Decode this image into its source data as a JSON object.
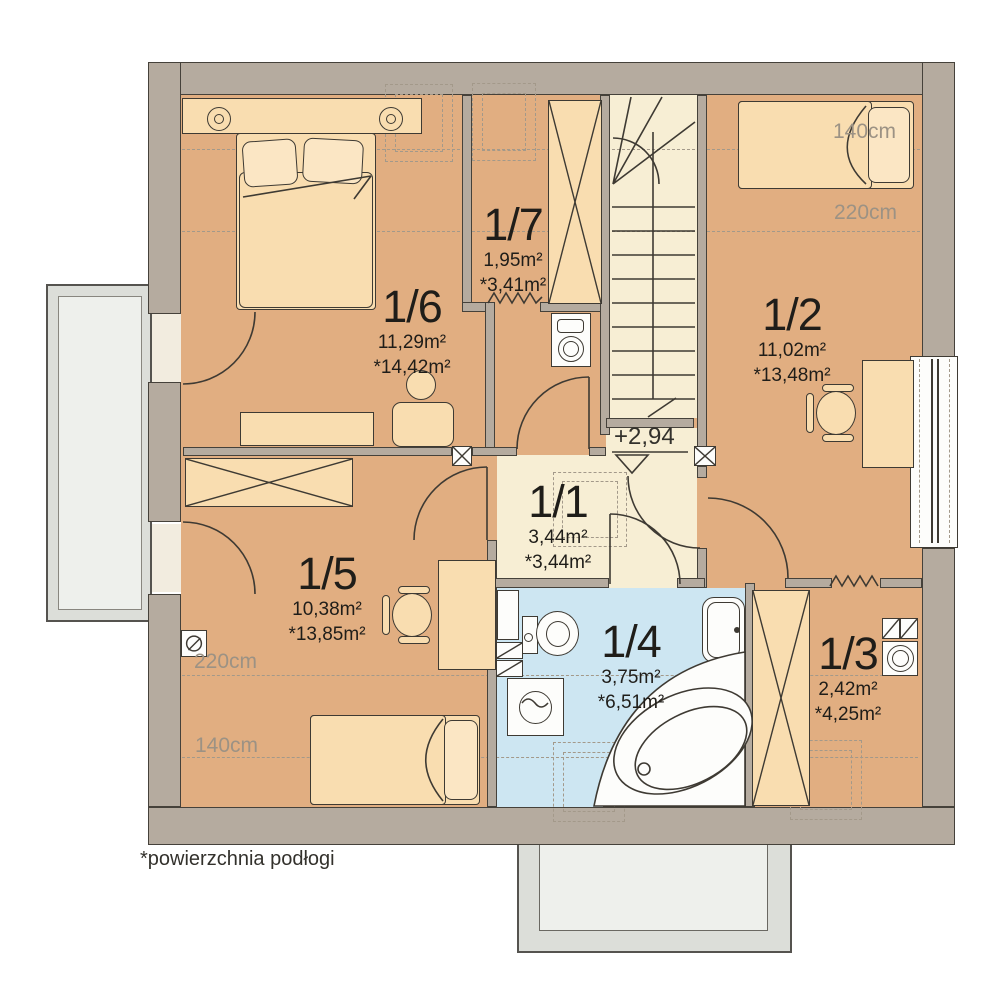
{
  "plan": {
    "footnote": "*powierzchnia podłogi",
    "level": "+2,94"
  },
  "rooms": {
    "r11": {
      "number": "1/1",
      "area": "3,44m²",
      "floor": "*3,44m²"
    },
    "r12": {
      "number": "1/2",
      "area": "11,02m²",
      "floor": "*13,48m²"
    },
    "r13": {
      "number": "1/3",
      "area": "2,42m²",
      "floor": "*4,25m²"
    },
    "r14": {
      "number": "1/4",
      "area": "3,75m²",
      "floor": "*6,51m²"
    },
    "r15": {
      "number": "1/5",
      "area": "10,38m²",
      "floor": "*13,85m²"
    },
    "r16": {
      "number": "1/6",
      "area": "11,29m²",
      "floor": "*14,42m²"
    },
    "r17": {
      "number": "1/7",
      "area": "1,95m²",
      "floor": "*3,41m²"
    }
  },
  "dims": {
    "t140": "140cm",
    "t220": "220cm",
    "b220": "220cm",
    "b140": "140cm"
  },
  "colors": {
    "wall": "#b5ab9f",
    "wallline": "#45413a",
    "floor": "#e1ae81",
    "hall": "#f7eed4",
    "bath": "#cde6f2",
    "furn": "#f9ddb0",
    "furn2": "#fbe6c4",
    "line": "#3e3a33",
    "dash": "#a3998a",
    "muted": "#9c9284",
    "text": "#1f1d19",
    "balc": "#eef0ec",
    "balcdark": "#dcded9",
    "white": "#fdfdfb"
  }
}
